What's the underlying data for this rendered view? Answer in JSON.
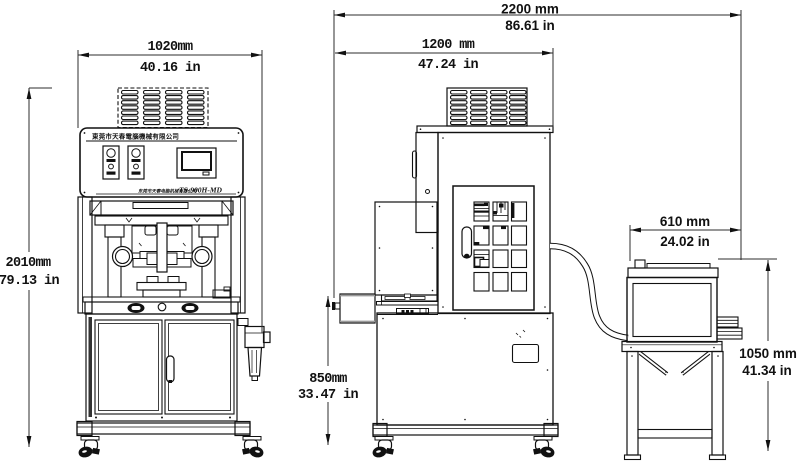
{
  "colors": {
    "ink": "#111111",
    "dim_line": "#2e2e2e",
    "background": "#ffffff"
  },
  "dims": {
    "front_width_mm": "1020mm",
    "front_width_in": "40.16 in",
    "front_height_mm": "2010mm",
    "front_height_in": "79.13 in",
    "side_total_mm": "2200 mm",
    "side_total_in": "86.61 in",
    "side_body_mm": "1200 mm",
    "side_body_in": "47.24 in",
    "side_table_mm": "850mm",
    "side_table_in": "33.47 in",
    "outfeed_width_mm": "610 mm",
    "outfeed_width_in": "24.02 in",
    "outfeed_height_mm": "1050 mm",
    "outfeed_height_in": "41.34 in"
  },
  "panel": {
    "company_name": "東莞市天春電腦機械有限公司",
    "footer_text": "东莞市天春电脑机械有限公司",
    "model_label": "TS-900H-MD"
  }
}
